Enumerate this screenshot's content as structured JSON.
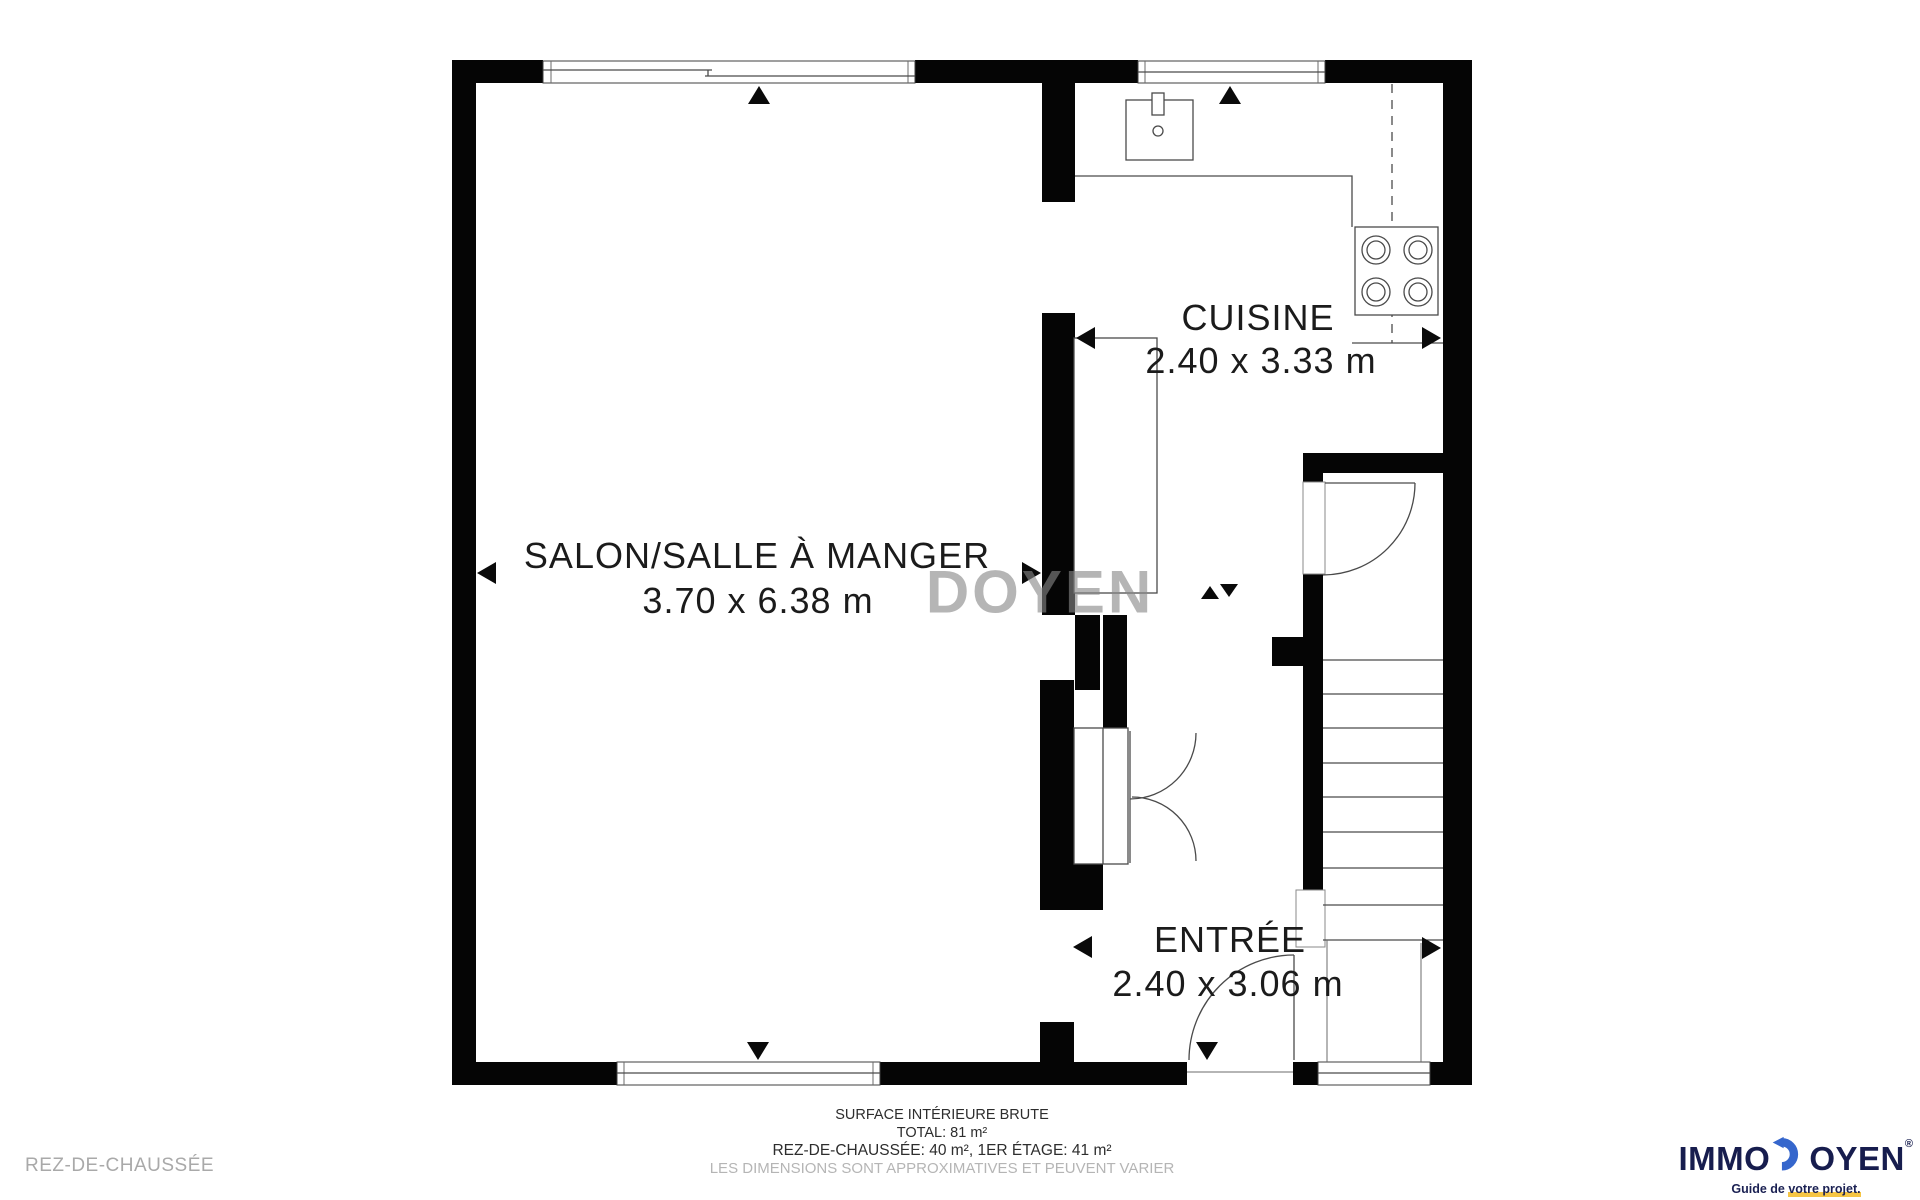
{
  "plan": {
    "watermark": "DOYEN",
    "rooms": [
      {
        "name": "SALON/SALLE À MANGER",
        "dimensions": "3.70 x 6.38 m"
      },
      {
        "name": "CUISINE",
        "dimensions": "2.40 x 3.33 m"
      },
      {
        "name": "ENTRÉE",
        "dimensions": "2.40 x 3.06 m"
      }
    ]
  },
  "footer": {
    "floor_label": "REZ-DE-CHAUSSÉE",
    "surface_title": "SURFACE INTÉRIEURE BRUTE",
    "surface_total": "TOTAL: 81 m²",
    "surface_breakdown": "REZ-DE-CHAUSSÉE: 40 m², 1ER ÉTAGE: 41 m²",
    "disclaimer": "LES DIMENSIONS SONT APPROXIMATIVES ET PEUVENT VARIER"
  },
  "logo": {
    "name_prefix": "IMMO",
    "name_suffix": "OYEN",
    "registered_mark": "®",
    "tagline_prefix": "Guide de ",
    "tagline_highlight": "votre projet.",
    "colors": {
      "navy": "#171d4e",
      "blue": "#3566cc",
      "yellow": "#f6c544"
    }
  }
}
